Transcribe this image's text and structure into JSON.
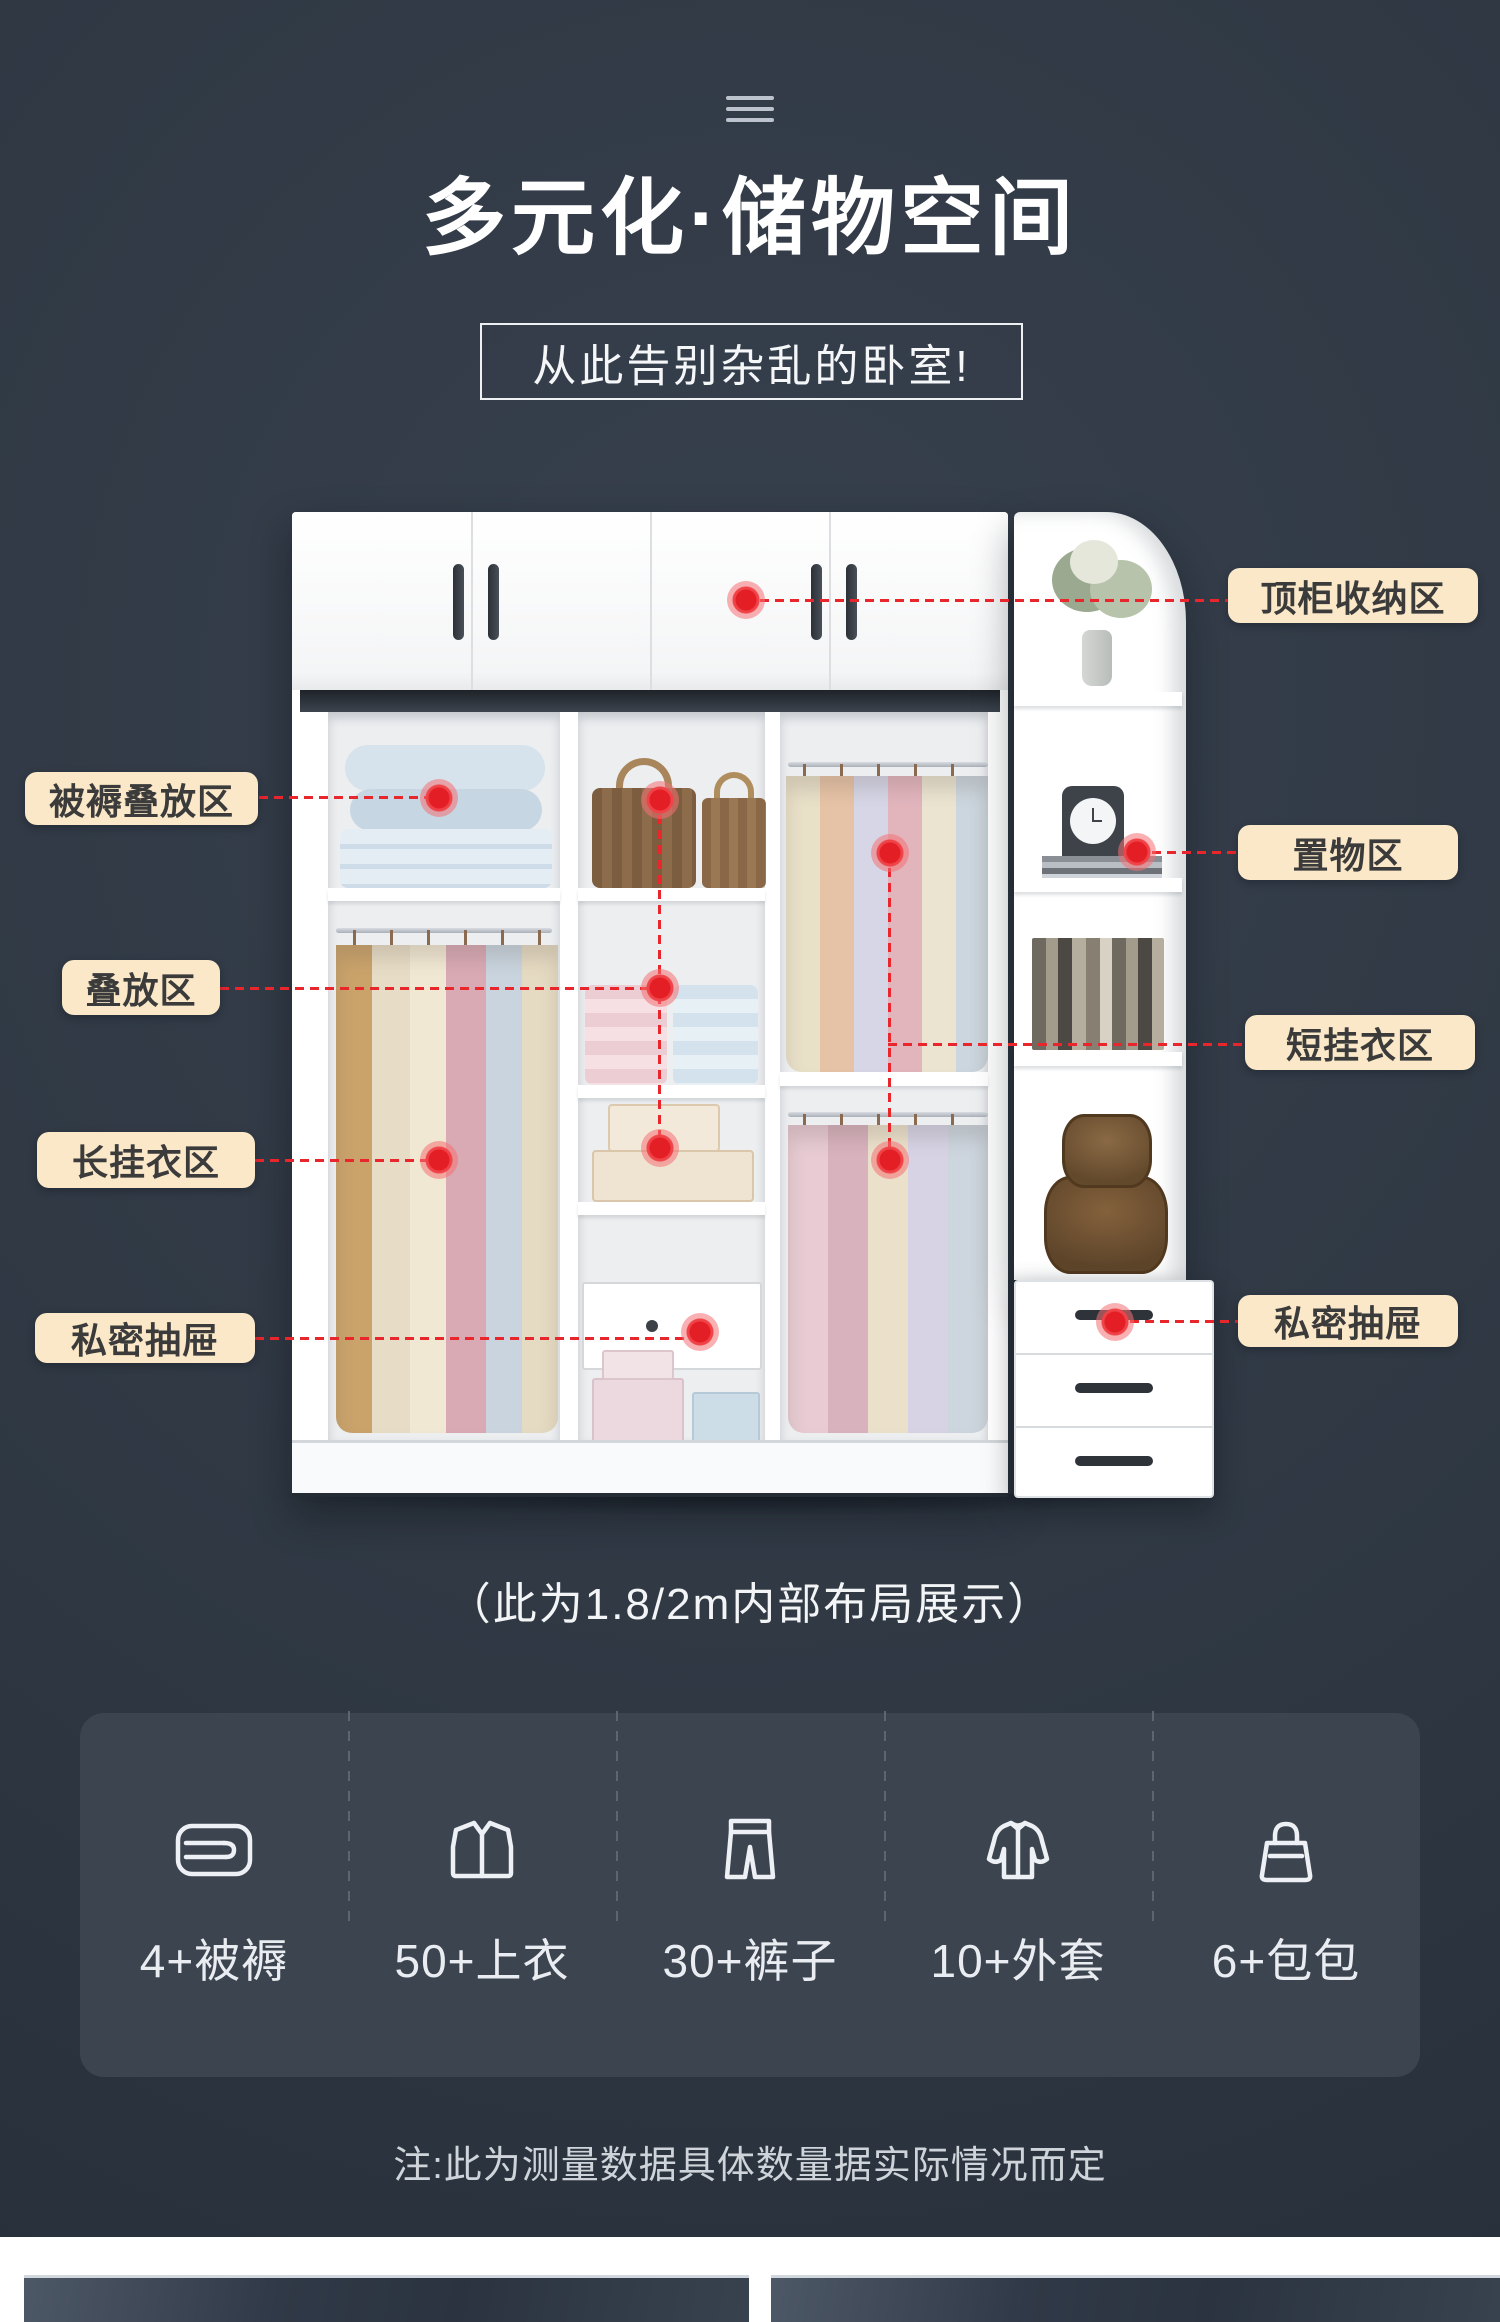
{
  "page": {
    "background": "#2f3843",
    "accent_red": "#e8262c",
    "label_bg": "#fae8c8",
    "label_text": "#3b3b3b",
    "card_bg": "#3c4450"
  },
  "header": {
    "menu_icon": "three-lines-icon",
    "title": "多元化·储物空间",
    "subtitle": "从此告别杂乱的卧室!"
  },
  "callouts": {
    "left": [
      {
        "text": "被褥叠放区"
      },
      {
        "text": "叠放区"
      },
      {
        "text": "长挂衣区"
      },
      {
        "text": "私密抽屉"
      }
    ],
    "right": [
      {
        "text": "顶柜收纳区"
      },
      {
        "text": "置物区"
      },
      {
        "text": "短挂衣区"
      },
      {
        "text": "私密抽屉"
      }
    ]
  },
  "caption": "（此为1.8/2m内部布局展示）",
  "stats": {
    "items": [
      {
        "icon": "bedding-icon",
        "label": "4+被褥"
      },
      {
        "icon": "shirt-icon",
        "label": "50+上衣"
      },
      {
        "icon": "pants-icon",
        "label": "30+裤子"
      },
      {
        "icon": "jacket-icon",
        "label": "10+外套"
      },
      {
        "icon": "bag-icon",
        "label": "6+包包"
      }
    ]
  },
  "note": "注:此为测量数据具体数量据实际情况而定"
}
